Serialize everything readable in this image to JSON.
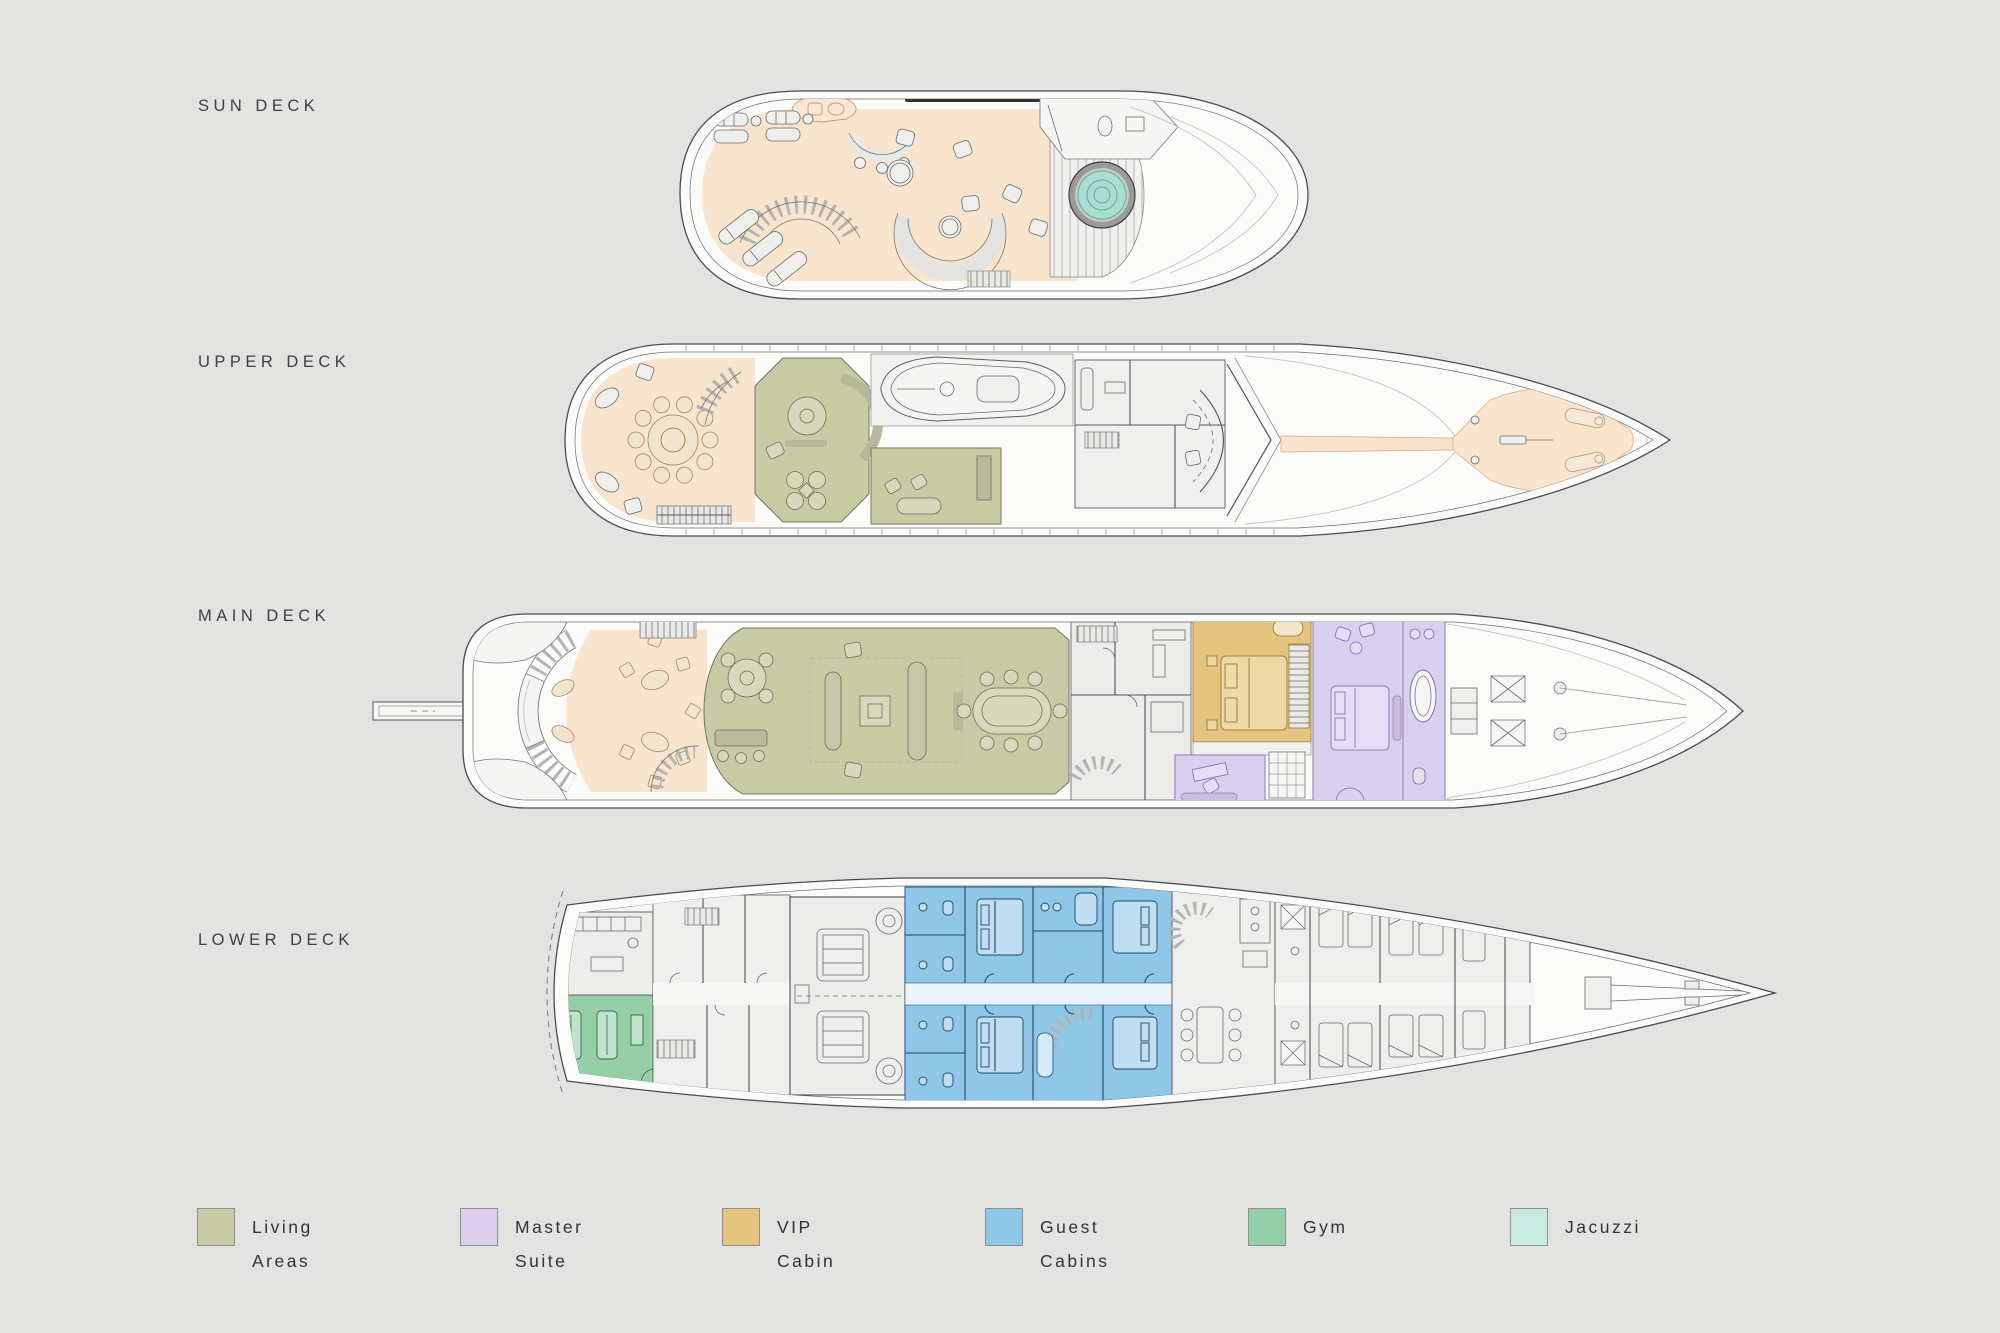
{
  "page": {
    "background": "#e3e3e2"
  },
  "decks": [
    {
      "id": "sun-deck",
      "label": "SUN DECK"
    },
    {
      "id": "upper-deck",
      "label": "UPPER DECK"
    },
    {
      "id": "main-deck",
      "label": "MAIN DECK"
    },
    {
      "id": "lower-deck",
      "label": "LOWER DECK"
    }
  ],
  "legend": {
    "items": [
      {
        "label_line1": "Living",
        "label_line2": "Areas",
        "color": "#c9cba4"
      },
      {
        "label_line1": "Master",
        "label_line2": "Suite",
        "color": "#dcd0ee"
      },
      {
        "label_line1": "VIP",
        "label_line2": "Cabin",
        "color": "#e4c47f"
      },
      {
        "label_line1": "Guest",
        "label_line2": "Cabins",
        "color": "#90c8e8"
      },
      {
        "label_line1": "Gym",
        "label_line2": "",
        "color": "#93cfa8"
      },
      {
        "label_line1": "Jacuzzi",
        "label_line2": "",
        "color": "#c7eae1"
      }
    ]
  },
  "colors": {
    "background": "#e3e3e2",
    "deck_open_area": "#f9e4cd",
    "living_areas": "#c9cba4",
    "master_suite": "#d9cfee",
    "vip_cabin": "#e4c47f",
    "guest_cabins": "#8fc7e8",
    "gym": "#95cfa7",
    "jacuzzi_water": "#a9ded2",
    "outline": "#4c4c4c"
  }
}
